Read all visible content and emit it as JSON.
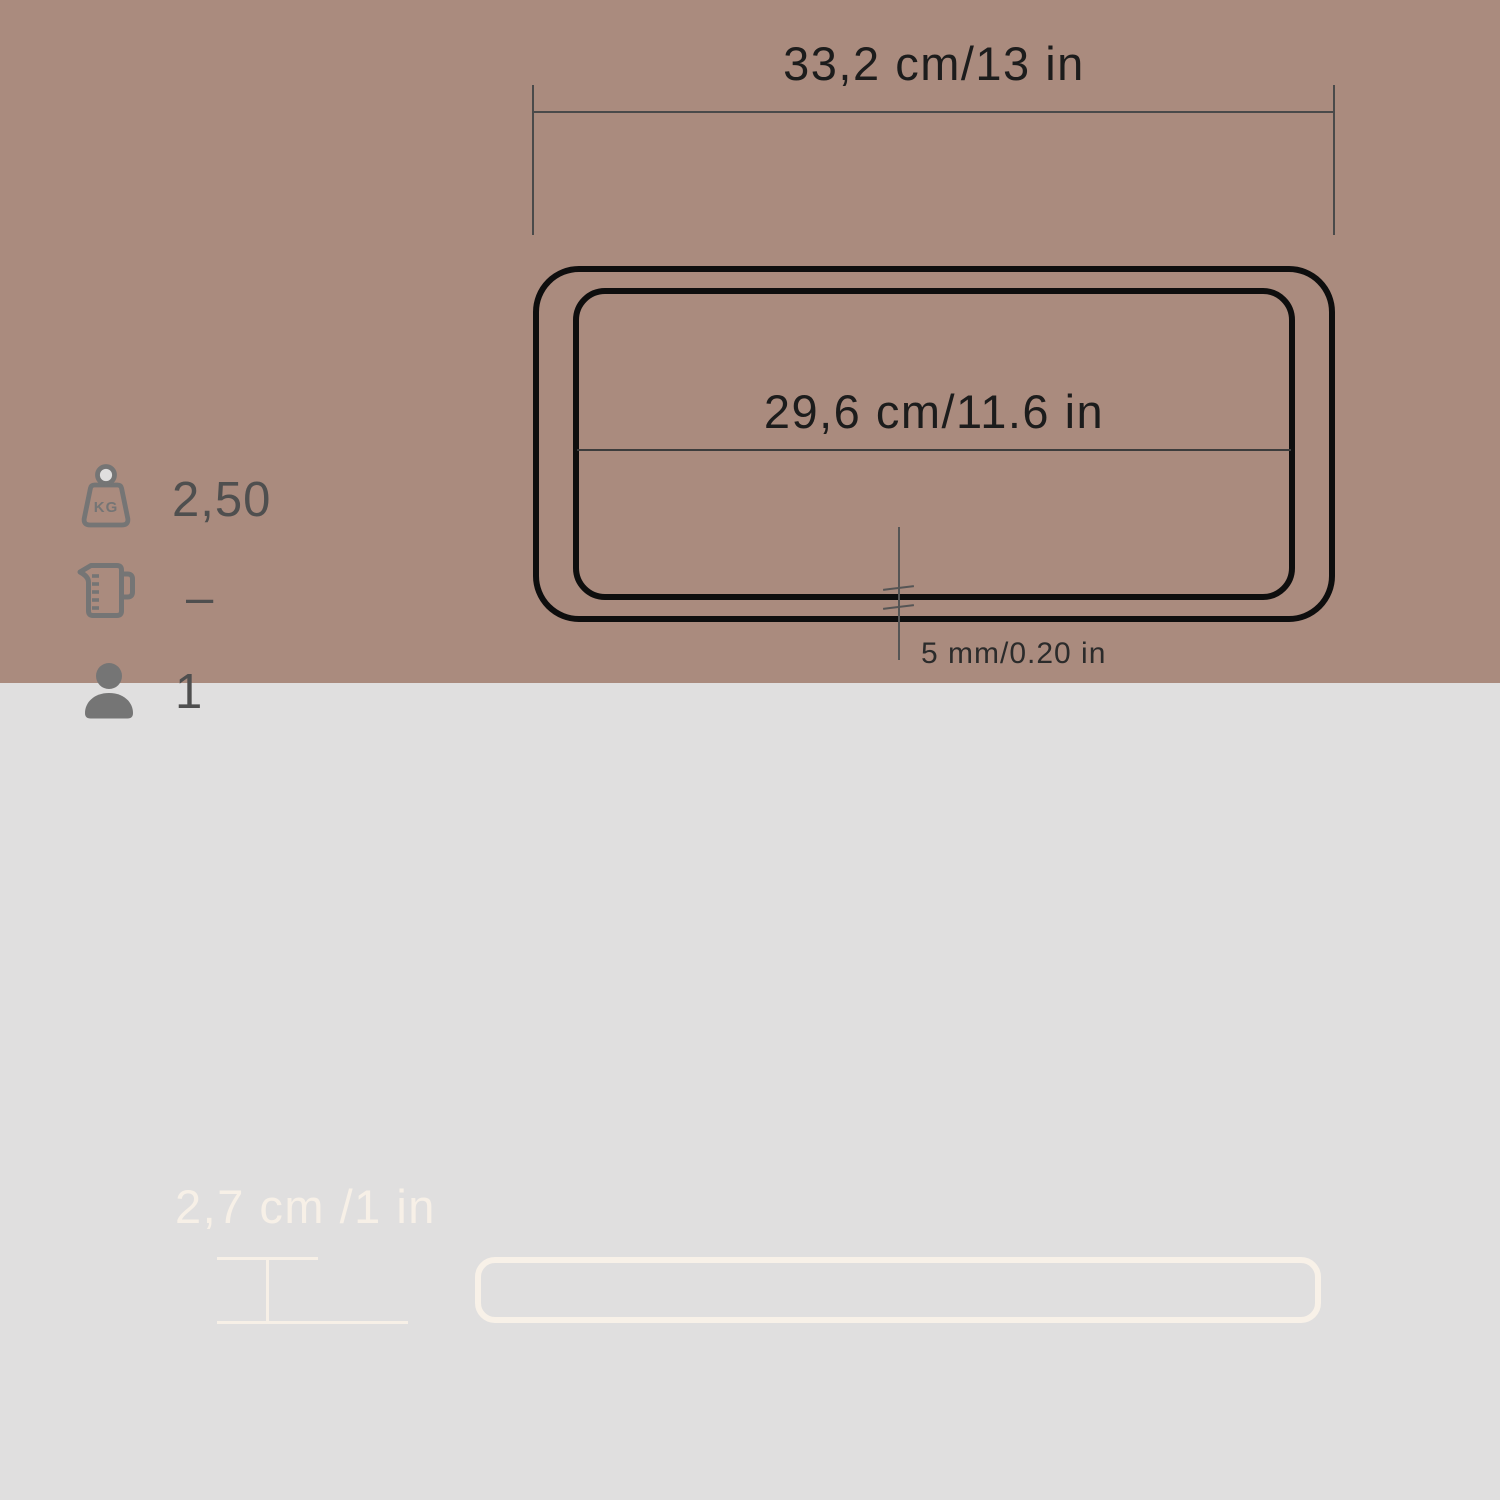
{
  "background": {
    "top_color": "#e0dfdf",
    "bottom_color": "#aa8b7e"
  },
  "colors": {
    "dimension_line": "#4a4a4a",
    "tray_outline": "#0e0e0e",
    "icon_gray": "#757575",
    "cream": "#f7f0e7"
  },
  "top_view": {
    "overall_width_label": "33,2 cm/13 in",
    "inner_width_label": "29,6 cm/11.6 in",
    "edge_thickness_label": "5 mm/0.20 in"
  },
  "specs": [
    {
      "icon": "weight-kg-icon",
      "icon_text": "KG",
      "value": "2,50"
    },
    {
      "icon": "measuring-jug-icon",
      "value": "–"
    },
    {
      "icon": "person-icon",
      "value": "1"
    }
  ],
  "side_view": {
    "height_label": "2,7 cm /1 in"
  }
}
